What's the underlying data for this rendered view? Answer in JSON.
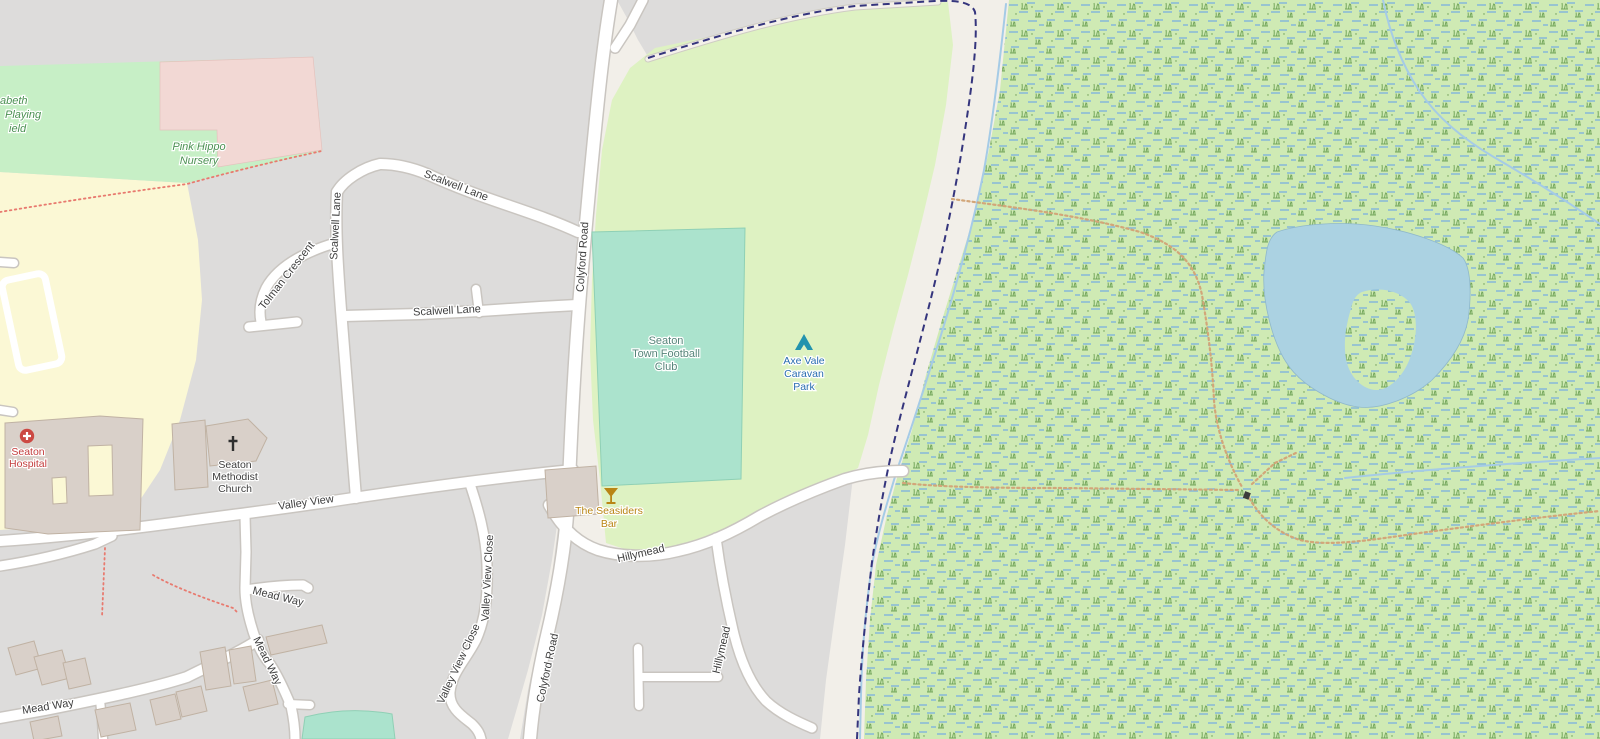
{
  "map": {
    "kind": "openstreetmap-style street map, Seaton (Devon) area",
    "roads": {
      "colyford_road": "Colyford Road",
      "scalwell_lane": "Scalwell Lane",
      "tolman_crescent": "Tolman Crescent",
      "valley_view": "Valley View",
      "valley_view_close": "Valley View Close",
      "mead_way": "Mead Way",
      "hillymead": "Hillymead"
    },
    "pois": {
      "playing_field": {
        "line1": "abeth",
        "line2": "Playing",
        "line3": "ield"
      },
      "nursery": {
        "line1": "Pink Hippo",
        "line2": "Nursery"
      },
      "football_club": {
        "line1": "Seaton",
        "line2": "Town Football",
        "line3": "Club"
      },
      "caravan_park": {
        "line1": "Axe Vale",
        "line2": "Caravan",
        "line3": "Park"
      },
      "hospital": {
        "line1": "Seaton",
        "line2": "Hospital"
      },
      "church": {
        "line1": "Seaton",
        "line2": "Methodist",
        "line3": "Church"
      },
      "bar": {
        "line1": "The Seasiders",
        "line2": "Bar"
      }
    },
    "icons": {
      "hospital": "red circle with white cross",
      "church": "black latin cross",
      "bar": "amber cocktail glass",
      "caravan_park": "teal tent",
      "gate": "small dark gate marker"
    },
    "colors": {
      "land_cream": "#f2efe9",
      "urban_gray": "#dddcdb",
      "school_yellow": "#fbf8d5",
      "field_green": "#c7efc6",
      "nursery_pink": "#f2d8d4",
      "caravan_green": "#def2c2",
      "marsh_green": "#cfeab4",
      "marsh_dash_blue": "#85b8da",
      "marsh_grass_green": "#74a75c",
      "pitch_teal": "#abe3cd",
      "water_blue": "#abd2e2",
      "stream_blue": "#a5cbe6",
      "building_tan": "#d9d0c9",
      "road_white": "#ffffff",
      "road_casing": "#c9c5c0",
      "boundary_navy": "#35357d",
      "footpath_red": "#e87a6f",
      "track_dots_tan": "#d2a679",
      "hospital_red": "#c33c3c",
      "bar_amber": "#b98514",
      "caravan_blue": "#2a6db0",
      "tent_teal": "#2293ae"
    }
  }
}
